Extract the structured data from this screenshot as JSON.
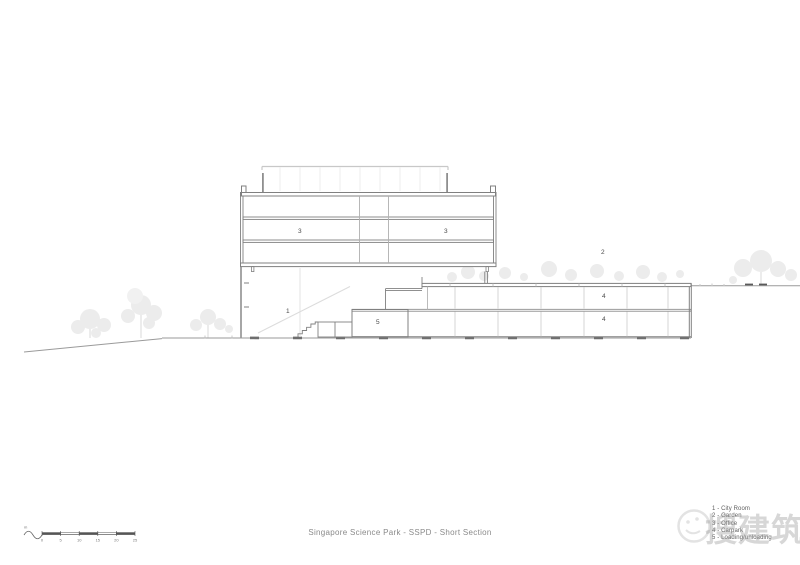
{
  "drawing": {
    "title": "Singapore Science Park - SSPD - Short Section",
    "labels": {
      "city_room": "1",
      "garden": "2",
      "office_left": "3",
      "office_right": "3",
      "carpark_upper": "4",
      "carpark_lower": "4",
      "loading": "5"
    },
    "legend_items": [
      "1 - City Room",
      "2 - Garden",
      "3 - Office",
      "4 - Carpark",
      "5 - Loading/unloading"
    ],
    "scale_bar": {
      "unit": "m",
      "ticks": [
        "0",
        "5",
        "10",
        "15",
        "20",
        "25"
      ]
    },
    "watermark_text": "搜建筑",
    "colors": {
      "line": "#8a8a8a",
      "line_dark": "#5f5f5f",
      "faint": "#d9d9d9",
      "tree": "#ececec",
      "text": "#8a8a8a"
    }
  }
}
